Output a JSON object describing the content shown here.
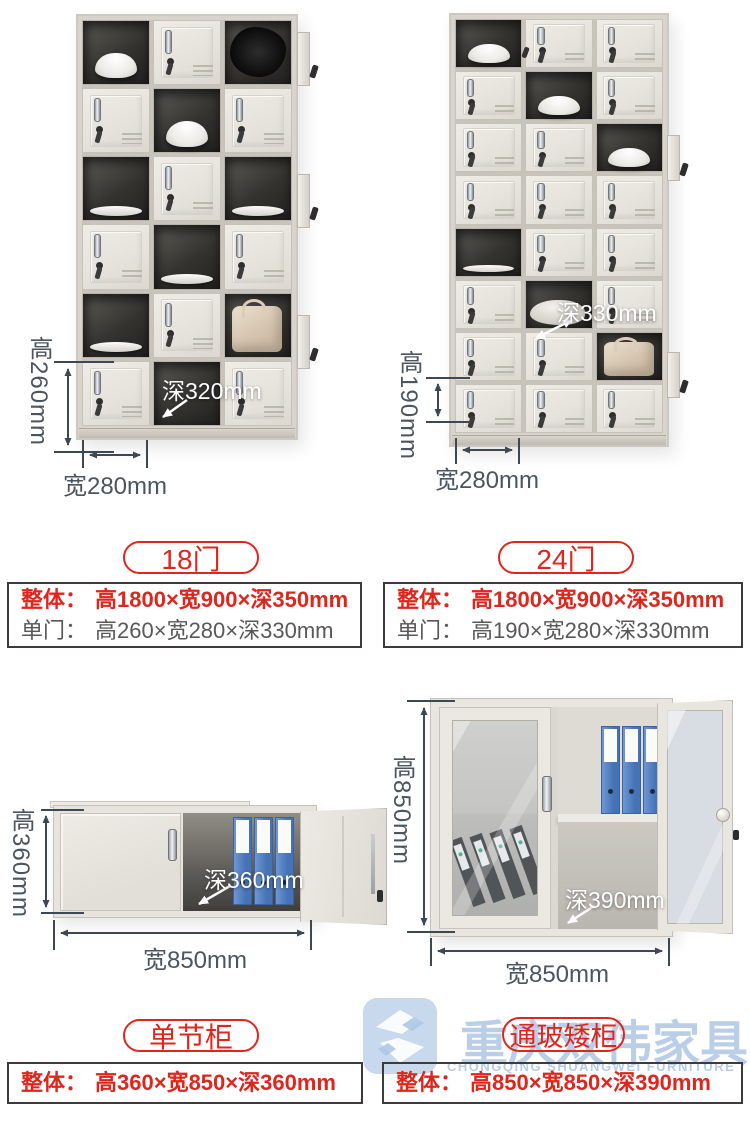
{
  "colors": {
    "red": "#e0251c",
    "gray_text": "#595757",
    "dim_text": "#4a5560",
    "dim_line": "#3d4852",
    "watermark_blue": "#a9c3e3"
  },
  "products": [
    {
      "pill": "18门",
      "annotations": {
        "height": "高260mm",
        "width": "宽280mm",
        "depth": "深320mm"
      },
      "specs": [
        {
          "label": "整体：",
          "value": "高1800×宽900×深350mm"
        },
        {
          "label": "单门：",
          "value": "高260×宽280×深330mm"
        }
      ]
    },
    {
      "pill": "24门",
      "annotations": {
        "height": "高190mm",
        "width": "宽280mm",
        "depth": "深330mm"
      },
      "specs": [
        {
          "label": "整体：",
          "value": "高1800×宽900×深350mm"
        },
        {
          "label": "单门：",
          "value": "高190×宽280×深330mm"
        }
      ]
    },
    {
      "pill": "单节柜",
      "annotations": {
        "height": "高360mm",
        "width": "宽850mm",
        "depth": "深360mm"
      },
      "specs": [
        {
          "label": "整体：",
          "value": "高360×宽850×深360mm"
        }
      ]
    },
    {
      "pill": "通玻矮柜",
      "annotations": {
        "height": "高850mm",
        "width": "宽850mm",
        "depth": "深390mm"
      },
      "specs": [
        {
          "label": "整体：",
          "value": "高850×宽850×深390mm"
        }
      ]
    }
  ],
  "lockers": {
    "locker18": {
      "rows": 6,
      "cols": 3,
      "open": {
        "1,1": "bowl",
        "1,3": "clothes",
        "2,2": "bowl",
        "3,1": "plate",
        "3,3": "plate",
        "4,2": "plate",
        "5,1": "plate",
        "5,3": "bag",
        "6,2": "empty"
      }
    },
    "locker24": {
      "rows": 8,
      "cols": 3,
      "open": {
        "1,1": "bowl",
        "2,2": "bowl",
        "3,3": "bowl",
        "5,1": "plate",
        "6,2": "clothes_light",
        "7,3": "bag"
      }
    }
  },
  "watermark": {
    "cn": "重庆双伟家具",
    "en": "CHONGQING SHUANGWEI FURNITURE"
  }
}
